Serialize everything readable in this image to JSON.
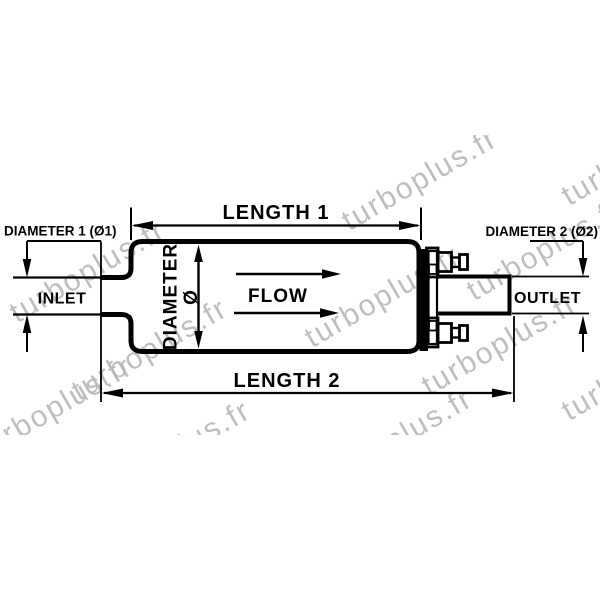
{
  "diagram": {
    "type": "fuel-pump-dimensional-drawing",
    "labels": {
      "length1": "LENGTH 1",
      "length2": "LENGTH 2",
      "diameter1": "DIAMETER 1 (Ø1)",
      "diameter2": "DIAMETER 2 (Ø2)",
      "diameter": "DIAMETER",
      "diameter_symbol": "Ø",
      "inlet": "INLET",
      "outlet": "OUTLET",
      "flow": "FLOW"
    },
    "colors": {
      "line": "#000000",
      "background": "#ffffff",
      "watermark": "#b7b7b7"
    }
  },
  "watermark": {
    "text": "turboplus.fr",
    "color": "#b7b7b7",
    "positions": [
      {
        "x": 88,
        "y": 272
      },
      {
        "x": 420,
        "y": 180
      },
      {
        "x": 640,
        "y": 155
      },
      {
        "x": 383,
        "y": 297
      },
      {
        "x": 545,
        "y": 250
      },
      {
        "x": 150,
        "y": 350
      },
      {
        "x": 55,
        "y": 408
      },
      {
        "x": 173,
        "y": 452
      },
      {
        "x": 395,
        "y": 440
      },
      {
        "x": 500,
        "y": 345
      },
      {
        "x": 640,
        "y": 370
      }
    ]
  }
}
